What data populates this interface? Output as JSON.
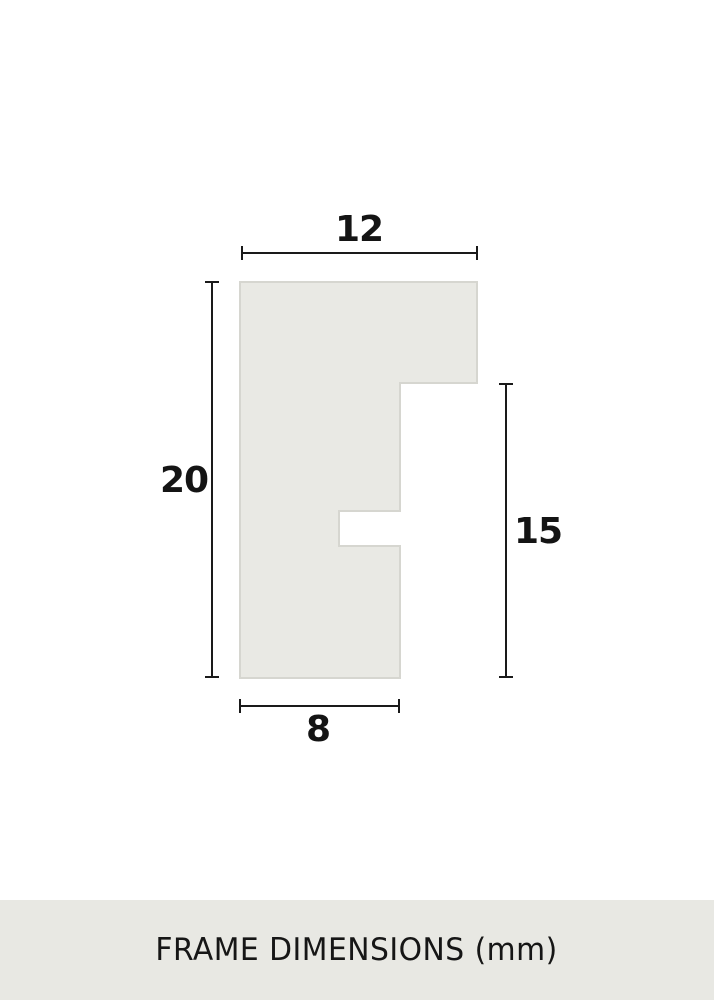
{
  "diagram": {
    "dimensions": {
      "top": "12",
      "left": "20",
      "right": "15",
      "bottom": "8"
    },
    "unit_note": "mm"
  },
  "caption": {
    "text": "FRAME DIMENSIONS (mm)"
  },
  "colors": {
    "page_background": "#ffffff",
    "profile_fill": "#e9e9e4",
    "profile_stroke": "#d6d6d0",
    "dimension_line": "#1a1a1a",
    "label_text": "#141414",
    "caption_bar_bg": "#e8e8e3",
    "caption_text": "#161616"
  }
}
